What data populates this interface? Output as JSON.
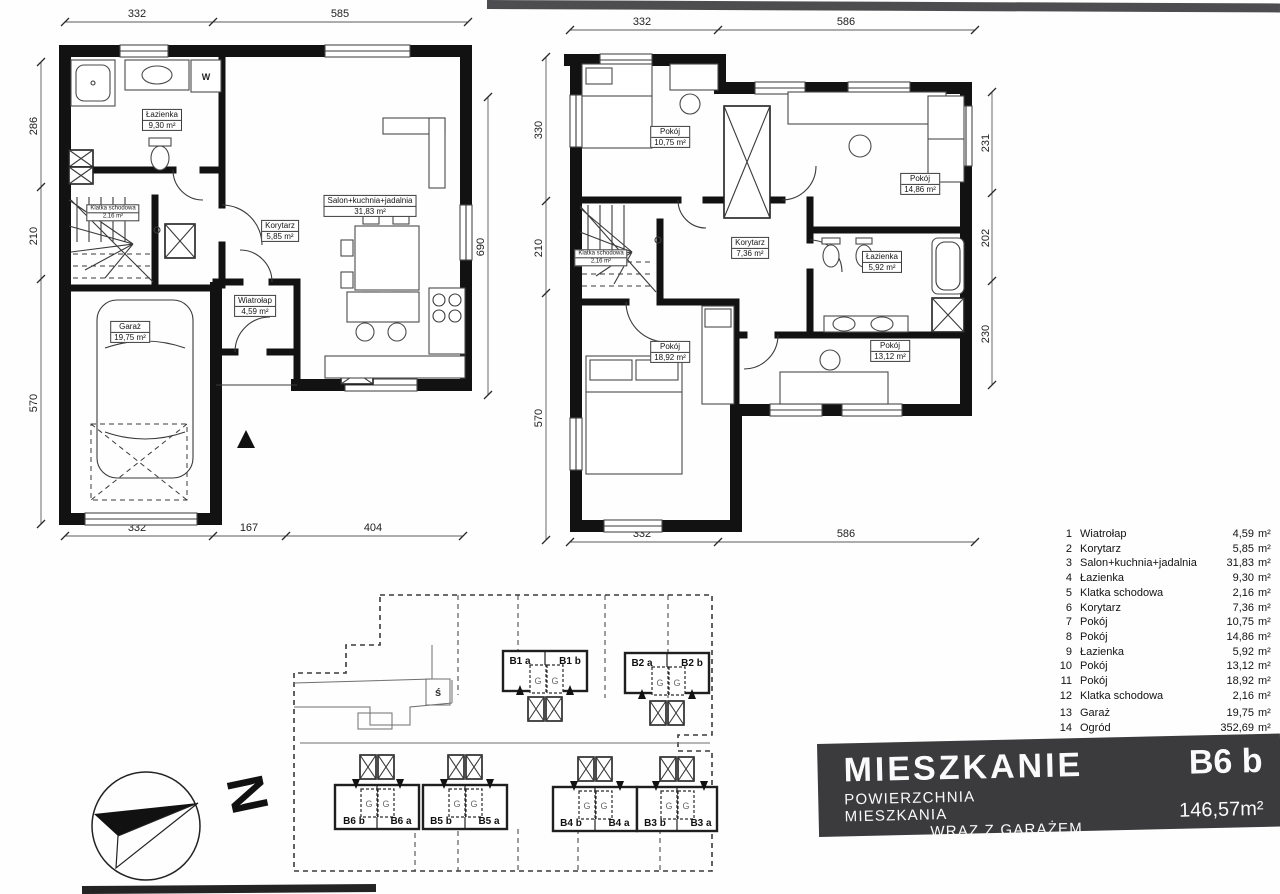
{
  "floor1": {
    "w_label": "W",
    "rooms": {
      "lazienka": {
        "name": "Łazienka",
        "area": "9,30 m²"
      },
      "klatka": {
        "name": "Klatka schodowa",
        "area": "2,16 m²"
      },
      "korytarz": {
        "name": "Korytarz",
        "area": "5,85 m²"
      },
      "salon": {
        "name": "Salon+kuchnia+jadalnia",
        "area": "31,83 m²"
      },
      "wiatrolap": {
        "name": "Wiatrołap",
        "area": "4,59 m²"
      },
      "garaz": {
        "name": "Garaż",
        "area": "19,75 m²"
      }
    },
    "dims": {
      "top": [
        "332",
        "585"
      ],
      "left": [
        "286",
        "210",
        "570"
      ],
      "right": [
        "690"
      ],
      "bottom": [
        "332",
        "167",
        "404"
      ]
    }
  },
  "floor2": {
    "rooms": {
      "pokoj1": {
        "name": "Pokój",
        "area": "10,75 m²"
      },
      "pokoj2": {
        "name": "Pokój",
        "area": "14,86 m²"
      },
      "korytarz": {
        "name": "Korytarz",
        "area": "7,36 m²"
      },
      "lazienka": {
        "name": "Łazienka",
        "area": "5,92 m²"
      },
      "klatka": {
        "name": "Klatka schodowa",
        "area": "2,16 m²"
      },
      "pokoj3": {
        "name": "Pokój",
        "area": "18,92 m²"
      },
      "pokoj4": {
        "name": "Pokój",
        "area": "13,12 m²"
      }
    },
    "dims": {
      "top": [
        "332",
        "586"
      ],
      "left": [
        "330",
        "210",
        "570"
      ],
      "right": [
        "231",
        "202",
        "230"
      ],
      "bottom": [
        "332",
        "586"
      ]
    }
  },
  "legend": {
    "unit": "m²",
    "items": [
      {
        "no": "1",
        "name": "Wiatrołap",
        "area": "4,59"
      },
      {
        "no": "2",
        "name": "Korytarz",
        "area": "5,85"
      },
      {
        "no": "3",
        "name": "Salon+kuchnia+jadalnia",
        "area": "31,83"
      },
      {
        "no": "4",
        "name": "Łazienka",
        "area": "9,30"
      },
      {
        "no": "5",
        "name": "Klatka schodowa",
        "area": "2,16"
      },
      {
        "no": "6",
        "name": "Korytarz",
        "area": "7,36"
      },
      {
        "no": "7",
        "name": "Pokój",
        "area": "10,75"
      },
      {
        "no": "8",
        "name": "Pokój",
        "area": "14,86"
      },
      {
        "no": "9",
        "name": "Łazienka",
        "area": "5,92"
      },
      {
        "no": "10",
        "name": "Pokój",
        "area": "13,12"
      },
      {
        "no": "11",
        "name": "Pokój",
        "area": "18,92"
      },
      {
        "no": "12",
        "name": "Klatka schodowa",
        "area": "2,16"
      },
      {
        "no": "13",
        "name": "Garaż",
        "area": "19,75"
      },
      {
        "no": "14",
        "name": "Ogród",
        "area": "352,69"
      }
    ]
  },
  "title_block": {
    "title": "MIESZKANIE",
    "unit_code": "B6 b",
    "subtitle_line1": "POWIERZCHNIA MIESZKANIA",
    "subtitle_line2": "WRAZ Z GARAŻEM",
    "area": "146,57m²"
  },
  "site": {
    "marker": "ś",
    "garage_letter": "G",
    "units": [
      {
        "label": "B1 a"
      },
      {
        "label": "B1 b"
      },
      {
        "label": "B2 a"
      },
      {
        "label": "B2 b"
      },
      {
        "label": "B6 b"
      },
      {
        "label": "B6 a"
      },
      {
        "label": "B5 b"
      },
      {
        "label": "B5 a"
      },
      {
        "label": "B4 b"
      },
      {
        "label": "B4 a"
      },
      {
        "label": "B3 b"
      },
      {
        "label": "B3 a"
      }
    ]
  },
  "compass": {
    "letter": "N"
  }
}
